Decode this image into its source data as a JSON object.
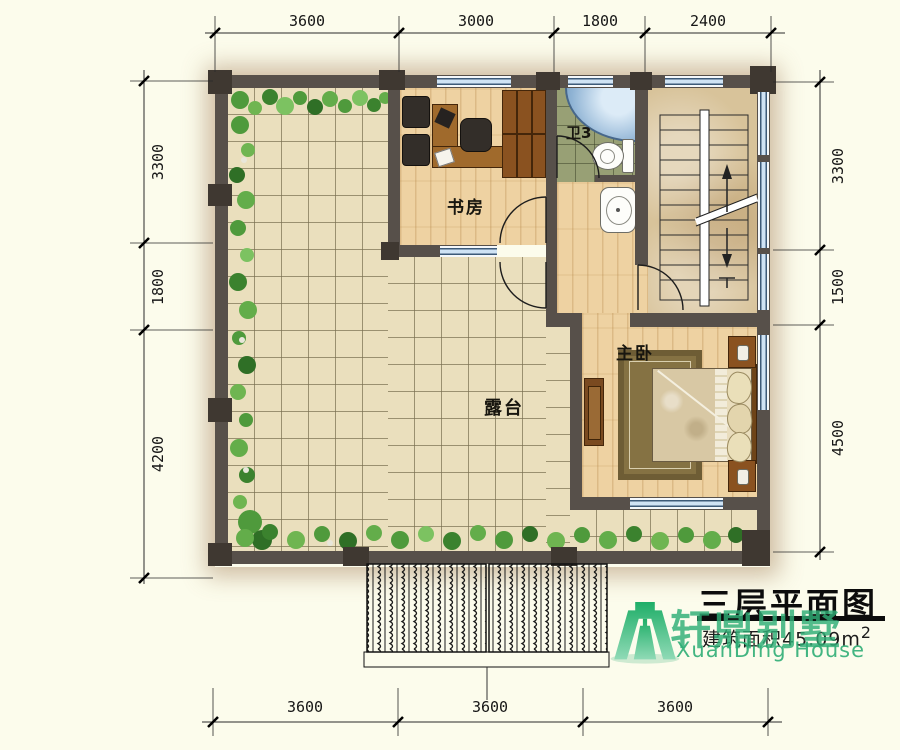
{
  "drawing": {
    "title": "三层平面图",
    "area_text": "建筑面积45.09m",
    "area_superscript": "2"
  },
  "watermark": {
    "brand_cn": "轩鼎别墅",
    "brand_en": "XuanDing House",
    "logo": "green-gate-logo",
    "brand_color": "#2fae76"
  },
  "room_labels": {
    "study": "书房",
    "bathroom": "卫3",
    "terrace": "露台",
    "master_bedroom": "主卧"
  },
  "dimensions": {
    "top": [
      "3600",
      "3000",
      "1800",
      "2400"
    ],
    "bottom": [
      "3600",
      "3600",
      "3600"
    ],
    "left": [
      "3300",
      "1800",
      "4200"
    ],
    "right": [
      "3300",
      "1500",
      "4500"
    ]
  }
}
